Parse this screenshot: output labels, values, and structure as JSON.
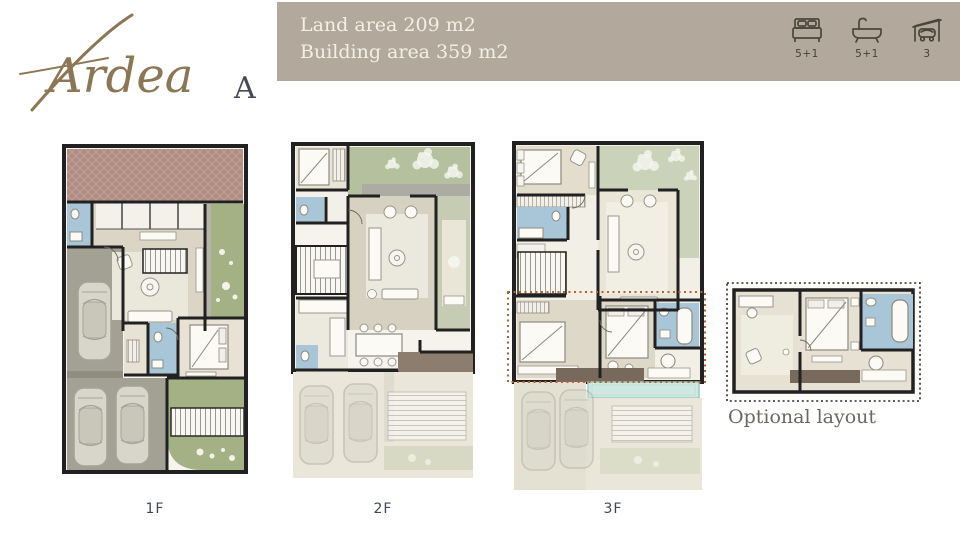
{
  "logo": {
    "script": "Ardea",
    "variant": "A"
  },
  "banner": {
    "land": "Land area 209 m2",
    "building": "Building area 359 m2"
  },
  "stats": {
    "bedrooms": "5+1",
    "bathrooms": "5+1",
    "garage": "3"
  },
  "plans": {
    "p1": "1F",
    "p2": "2F",
    "p3": "3F",
    "optional": "Optional layout"
  },
  "palette": {
    "banner_bg": "#b2a99c",
    "banner_text": "#f3efe6",
    "logo_gold": "#8b7754",
    "logo_dark": "#454a54",
    "icon_stroke": "#4b463d",
    "wall": "#212121",
    "floor_cream": "#dbd5c5",
    "floor_light": "#f3f1ea",
    "garden_green": "#a4b184",
    "garden_pale": "#c5ccb3",
    "drive_gray": "#a2a193",
    "bath_blue": "#a9c6d8",
    "terrace_brick": "#b08d83",
    "entry_brown": "#8c7d6f",
    "deck_brown": "#77695c",
    "pool_teal": "#cfe9e2",
    "ghost_beige": "#eae7da",
    "optional_outline": "#2b2b2b",
    "dotted_overlay": "#b5622f",
    "label_text": "#414854",
    "caption_text": "#6b6862"
  }
}
